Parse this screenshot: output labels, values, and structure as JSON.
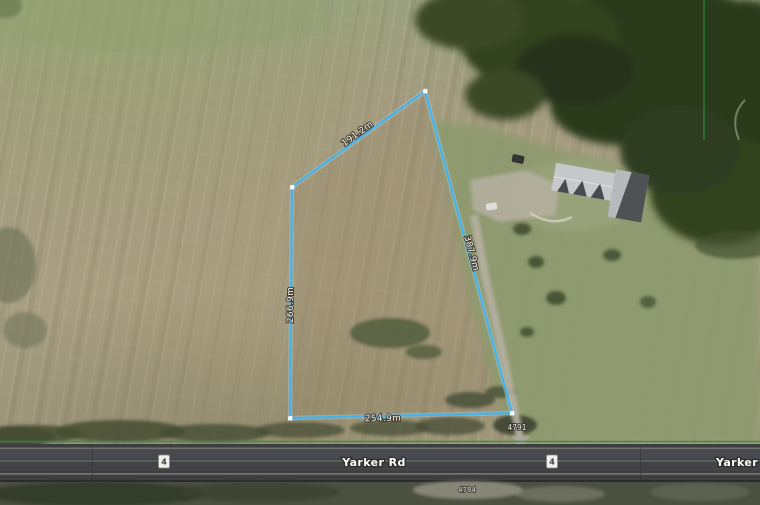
{
  "map": {
    "boundary_color": "#3fb3f0",
    "property_line_color": "#2e8f3c",
    "parcel": {
      "edge_labels": {
        "northwest": "191.2m",
        "west": "266.9m",
        "south": "254.9m",
        "east": "387.9m"
      },
      "address": "4791"
    },
    "road": {
      "name": "Yarker Rd",
      "name_truncated": "Yarker",
      "route_number": "4",
      "address_south": "4784"
    }
  }
}
